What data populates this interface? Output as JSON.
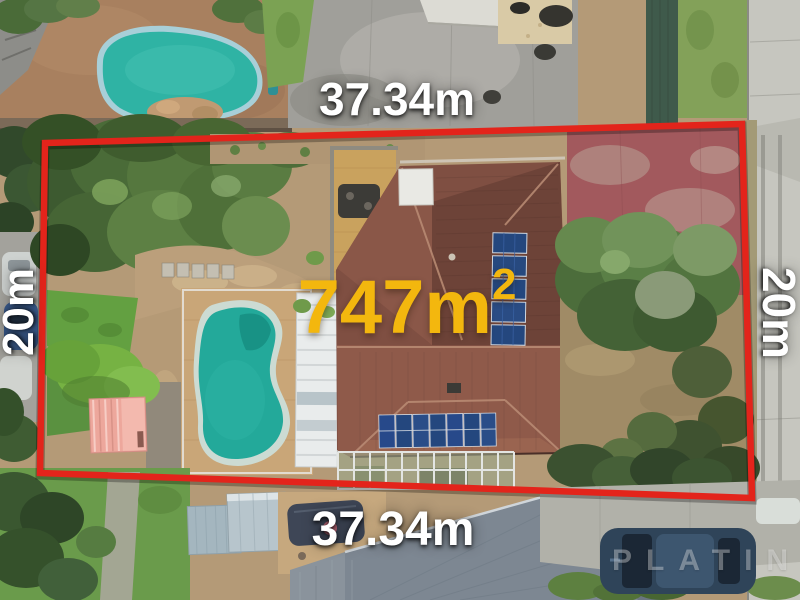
{
  "overlay": {
    "top_dimension": "37.34m",
    "bottom_dimension": "37.34m",
    "left_dimension": "20m",
    "right_dimension": "20m",
    "area_value": "747m",
    "area_exponent": "2",
    "watermark": "PLATINUM"
  },
  "palette": {
    "boundary_red": "#E3241B",
    "dimension_label_color": "#FFFFFF",
    "area_label_color": "#F3B70E",
    "pool_water_teal": "#23A99A",
    "neighbor_pool_teal": "#2FB3A4",
    "roof_tile_brown": "#7F4F42",
    "solar_panel_blue": "#24477E",
    "brick_paving_tan": "#C9A678",
    "red_concrete": "#A2595D",
    "lawn_green": "#63A041",
    "metal_roof_gray": "#7D8792"
  }
}
